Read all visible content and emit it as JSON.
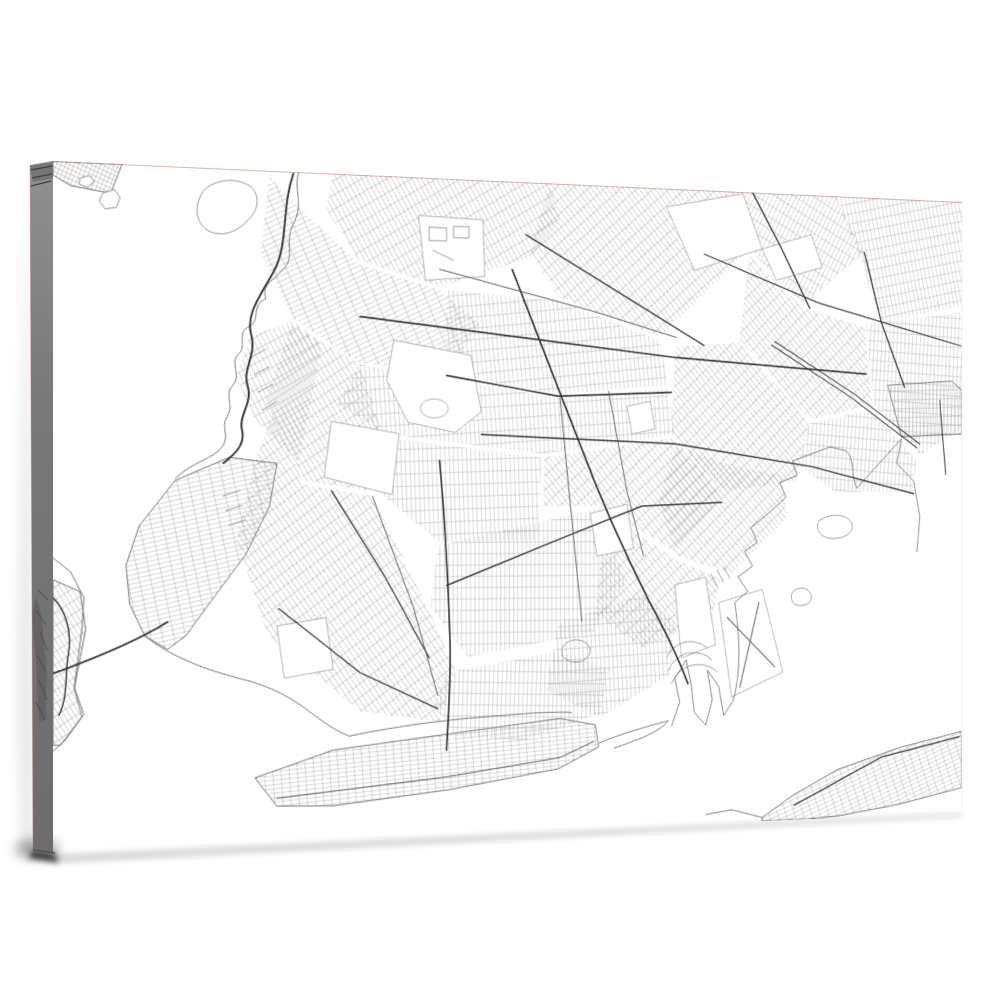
{
  "scene": {
    "description": "Gallery-wrapped canvas print mockup of a black-and-white Brooklyn street map, angled with left side edge visible",
    "background": "#ffffff",
    "canvas_face": "#ffffff",
    "canvas_side_top": "#909090",
    "canvas_side_mid": "#787878",
    "canvas_side_bottom": "#6d6d6d",
    "edge_hairline": "rgba(196,118,106,0.55)",
    "shadow_color": "#000000"
  },
  "map": {
    "colors": {
      "grid": "#8a8a8a",
      "coast": "#666666",
      "road": "#2f2f2f",
      "minor": "#555555",
      "park": "#8f8f8f",
      "detail": "#7f7f7f",
      "water": "#ffffff"
    },
    "districts": [
      {
        "n": "greenpoint-williamsburg",
        "a": -30,
        "w": 5,
        "h": 13,
        "p": "300,0 548,0 560,40 525,80 420,114 326,88 292,36"
      },
      {
        "n": "downtown-fortgreene",
        "a": -25,
        "w": 13,
        "h": 5,
        "p": "230,6 262,36 330,94 420,118 466,152 430,206 328,196 256,152 220,86"
      },
      {
        "n": "bushwick",
        "a": -40,
        "w": 5,
        "h": 12,
        "p": "548,0 762,0 790,62 680,162 560,122 524,76"
      },
      {
        "n": "ridgewood",
        "a": 28,
        "w": 5,
        "h": 12,
        "p": "762,0 898,0 936,62 858,122 800,72"
      },
      {
        "n": "queens-northeast",
        "a": -12,
        "w": 5,
        "h": 11,
        "p": "898,0 1063,0 1063,118 958,140 928,62"
      },
      {
        "n": "queens-east",
        "a": 3,
        "w": 5,
        "h": 11,
        "p": "938,142 1063,126 1063,258 1008,288 948,232"
      },
      {
        "n": "east-new-york",
        "a": -42,
        "w": 5,
        "h": 12,
        "p": "790,70 858,126 936,146 946,232 866,250 778,162"
      },
      {
        "n": "bedford-stuyvesant",
        "a": -6,
        "w": 5,
        "h": 12,
        "p": "428,118 560,126 680,166 690,214 558,226 428,206"
      },
      {
        "n": "crown-heights",
        "a": -4,
        "w": 5,
        "h": 13,
        "p": "330,198 558,230 690,218 698,268 538,290 358,270 304,240"
      },
      {
        "n": "brownsville",
        "a": -42,
        "w": 5,
        "h": 11,
        "p": "698,172 778,166 866,254 848,318 758,330 694,268"
      },
      {
        "n": "park-slope",
        "a": -32,
        "w": 5,
        "h": 12,
        "p": "254,158 330,198 356,272 340,330 268,320 226,238"
      },
      {
        "n": "flatbush",
        "a": -2,
        "w": 5,
        "h": 13,
        "p": "358,274 538,294 534,382 420,384 352,332"
      },
      {
        "n": "midwood",
        "a": 0,
        "w": 5,
        "h": 12,
        "p": "418,388 610,348 638,430 600,482 452,506 410,452"
      },
      {
        "n": "east-flatbush",
        "a": -40,
        "w": 5,
        "h": 12,
        "p": "542,294 694,272 758,334 698,396 610,346 540,346"
      },
      {
        "n": "canarsie",
        "a": -42,
        "w": 5,
        "h": 12,
        "p": "700,280 760,300 830,312 838,358 768,420 700,400 678,340"
      },
      {
        "n": "flatlands",
        "a": -40,
        "w": 5,
        "h": 12,
        "p": "614,352 698,404 754,426 744,468 658,500 602,462"
      },
      {
        "n": "borough-park-bensonhurst",
        "a": -35,
        "w": 5,
        "h": 12,
        "p": "234,250 268,324 344,336 408,456 438,520 420,574 330,560 228,480 194,380 214,300"
      },
      {
        "n": "sunset-park",
        "a": -28,
        "w": 5,
        "h": 12,
        "p": "208,172 256,154 288,178 262,300 214,258 194,214"
      },
      {
        "n": "bay-ridge",
        "a": -12,
        "w": 12,
        "h": 4.6,
        "o": 1,
        "p": "238,302 186,296 128,320 90,366 76,406 80,446 96,478 120,492 140,478 166,444 204,396 230,346"
      },
      {
        "n": "gravesend",
        "a": 2,
        "w": 5,
        "h": 12,
        "p": "428,522 558,502 618,522 608,570 518,596 438,590 414,556"
      },
      {
        "n": "sheepshead-bay",
        "a": -3,
        "w": 5,
        "h": 12,
        "p": "558,472 658,442 698,472 692,530 608,574 544,544"
      },
      {
        "n": "coney-island",
        "a": -4,
        "w": 9,
        "h": 4.5,
        "o": 1,
        "p": "214,626 300,600 440,586 560,574 602,582 606,606 558,628 430,646 300,658 238,656"
      },
      {
        "n": "rockaway",
        "a": -20,
        "w": 10,
        "h": 4.6,
        "o": 1,
        "p": "806,690 846,666 902,640 982,618 1063,602 1063,666 980,682 902,692 862,694 806,694"
      },
      {
        "n": "howard-beach",
        "a": -2,
        "w": 4.6,
        "h": 10,
        "o": 1,
        "p": "966,210 1050,204 1063,214 1063,264 984,268"
      },
      {
        "n": "staten-island-edge",
        "a": -32,
        "w": 4.6,
        "h": 11,
        "o": 1,
        "p": "0,420 28,432 34,470 22,530 30,558 8,586 0,586"
      },
      {
        "n": "manhattan-tip",
        "a": 22,
        "w": 4.2,
        "h": 4.5,
        "o": 1,
        "p": "0,0 72,0 60,30 18,24 0,14"
      },
      {
        "n": "ozone-park",
        "a": 4,
        "w": 5,
        "h": 12,
        "p": "866,254 946,238 1004,294 998,330 898,330 852,300"
      }
    ],
    "whites": [
      {
        "n": "prospect-park",
        "d": "M368,172 L456,186 L468,246 L438,268 L384,258 L360,214 Z"
      },
      {
        "n": "green-wood-cemetery",
        "d": "M298,258 L374,270 L366,334 L290,316 Z"
      },
      {
        "n": "evergreens-cemetery",
        "d": "M688,20 L782,2 L806,62 L722,88 Z"
      },
      {
        "n": "highland-park",
        "d": "M806,62 L868,44 L882,80 L824,96 Z"
      },
      {
        "n": "navy-yard",
        "d": "M396,40 L470,42 L472,102 L404,108 Z"
      },
      {
        "n": "dyker-park",
        "d": "M238,470 L292,462 L300,516 L246,524 Z"
      },
      {
        "n": "holy-cross-cemetery",
        "d": "M596,354 L640,344 L648,392 L604,400 Z"
      },
      {
        "n": "lincoln-terrace",
        "d": "M640,238 L668,232 L674,262 L646,268 Z"
      },
      {
        "n": "marine-park",
        "d": "M698,432 L736,424 L748,498 L706,512 Z"
      },
      {
        "n": "floyd-bennett-field",
        "d": "M752,452 L806,438 L832,530 L768,556 Z"
      },
      {
        "n": "prospect-lake",
        "d": "M398,242 a16,10 0 1 0 32,2 a16,10 0 1 0 -32,-2 Z"
      }
    ],
    "coasts": [
      {
        "n": "west-shore",
        "d": "M262,0 C256,18 268,34 256,54 C246,72 258,88 246,100 C236,112 220,118 226,132 C208,140 222,156 206,162 C194,170 206,182 196,190 C186,198 200,212 190,222 C180,232 192,242 184,254 C176,266 188,274 178,286 C168,298 148,300 128,318"
      },
      {
        "n": "gravesend-bay-shore",
        "d": "M96,478 C124,500 162,514 200,524 C232,532 256,546 272,558 C286,568 302,580 318,586"
      },
      {
        "n": "coney-creek",
        "d": "M318,586 C364,578 424,572 472,570 C512,568 546,566 574,568"
      },
      {
        "n": "sheepshead-inlet",
        "d": "M606,602 C634,592 662,586 690,580 M690,580 C680,592 652,600 624,608"
      },
      {
        "n": "gerritsen-coast",
        "d": "M694,586 L704,560 L698,534 L712,514 L718,542 L722,572 L736,586 L744,558 L738,526 L752,544 L758,576 L770,560"
      },
      {
        "n": "jamaica-bay-west",
        "d": "M770,560 C782,520 776,480 772,452 L788,440 L776,424 L794,412 L784,396 L800,386 L792,370 L814,354 L836,336 L828,320 L850,312 L844,296 L868,288 L892,280 L912,284 C924,292 918,310 926,326 L984,270"
      },
      {
        "n": "howard-coast",
        "d": "M984,270 L978,298 L1000,318 L1008,358 L1004,398"
      },
      {
        "n": "rockaway-inner",
        "d": "M806,690 L768,680 L736,684"
      },
      {
        "n": "staten-island-coast",
        "d": "M0,398 L18,412 L32,438 L30,470 L22,528 L32,556 L12,582 L0,592"
      }
    ],
    "islands": [
      {
        "n": "governors-island",
        "d": "M158,24 C170,10 198,8 210,18 C220,26 218,42 206,52 C194,66 174,72 160,62 C148,52 150,36 158,24 Z"
      },
      {
        "n": "liberty-island",
        "d": "M52,30 l12,-4 6,8 -4,10 -12,2 -6,-8 Z"
      },
      {
        "n": "ellis-island",
        "d": "M28,16 l10,-3 5,6 -8,6 -8,-3 Z"
      },
      {
        "n": "ruffle-bar",
        "d": "M878,362 c18,-10 38,-6 42,4 c4,10 -14,18 -28,16 c-14,-2 -20,-12 -14,-20 Z"
      },
      {
        "n": "canarsie-pol",
        "d": "M846,440 c10,-6 20,-2 22,6 c2,8 -10,12 -18,10 c-8,-2 -10,-12 -4,-16 Z"
      }
    ],
    "roads": [
      {
        "n": "bqe-gowanus-expwy",
        "w": 2,
        "d": "M256,2 C242,40 252,78 232,108 C218,132 204,150 210,170 C216,190 200,206 206,222 C212,240 196,252 200,268 C204,284 190,294 180,302"
      },
      {
        "n": "verrazzano-bridge",
        "w": 1.8,
        "d": "M120,464 C96,478 54,496 0,514"
      },
      {
        "n": "ocean-parkway",
        "w": 1.8,
        "d": "M420,298 C426,360 430,430 432,490 C433,530 430,568 428,604"
      },
      {
        "n": "flatbush-avenue",
        "w": 1.9,
        "d": "M504,94 C528,150 558,220 584,280 C608,338 638,398 666,448 C684,478 700,506 714,540"
      },
      {
        "n": "atlantic-avenue",
        "w": 1.7,
        "d": "M330,148 L700,184 L938,198"
      },
      {
        "n": "eastern-parkway",
        "w": 1.6,
        "d": "M428,208 L558,228 L694,222"
      },
      {
        "n": "linden-blvd",
        "w": 1.5,
        "d": "M468,270 L698,278 L868,302 L1000,332"
      },
      {
        "n": "kings-highway",
        "w": 1.4,
        "d": "M428,430 L558,382 L658,346 L756,342"
      },
      {
        "n": "conduit-ave-a",
        "w": 1.1,
        "d": "M818,168 L918,224 L1004,280"
      },
      {
        "n": "conduit-ave-b",
        "w": 1.1,
        "d": "M822,164 L922,220 L1008,276"
      },
      {
        "n": "jamaica-avenue",
        "w": 1.2,
        "d": "M734,70 L878,120 L1063,164"
      },
      {
        "n": "broadway",
        "w": 1.4,
        "d": "M520,56 L640,120 L734,170"
      },
      {
        "n": "myrtle-avenue",
        "w": 1,
        "c": "#555555",
        "d": "M420,96 L600,136 L700,162"
      },
      {
        "n": "new-utrecht-ave",
        "w": 1.3,
        "d": "M298,330 L358,420 L408,506"
      },
      {
        "n": "86th-street",
        "w": 1.2,
        "d": "M240,452 L330,520 L418,560"
      },
      {
        "n": "bay-parkway",
        "w": 1,
        "c": "#555555",
        "d": "M344,336 L390,452 L418,546"
      },
      {
        "n": "city-line",
        "w": 1.5,
        "d": "M794,0 L830,60 L866,126"
      },
      {
        "n": "woodhaven-blvd",
        "w": 1.5,
        "d": "M936,62 L958,140 L988,212"
      },
      {
        "n": "rockaway-spine",
        "w": 1.3,
        "d": "M846,678 L958,628 L1060,608"
      },
      {
        "n": "staten-island-road",
        "w": 1.4,
        "d": "M0,438 C12,450 20,470 16,494 C12,514 16,538 6,556"
      },
      {
        "n": "nostrand-ave",
        "w": 1,
        "c": "#555555",
        "d": "M560,230 L574,360 L586,470"
      },
      {
        "n": "utica-ave",
        "w": 1,
        "c": "#555555",
        "d": "M618,222 L640,330 L660,400"
      },
      {
        "n": "howard-vertical",
        "w": 1.2,
        "d": "M1034,226 L1042,310"
      },
      {
        "n": "coney-main",
        "w": 1,
        "c": "#555555",
        "d": "M238,648 L430,632 L560,616 L600,600"
      }
    ],
    "details": [
      {
        "n": "waterfront-piers",
        "d": "M226,184 l-16,9 M230,202 l-17,9 M234,220 l-17,9 M238,238 l-16,9 M198,330 l-19,6 M201,345 l-19,6 M204,360 l-19,6"
      },
      {
        "n": "gerritsen-arcs",
        "d": "M688,512 a30,26 0 0 1 50,-10 M690,526 a32,28 0 0 1 54,-11 M694,540 a34,30 0 0 1 56,-12"
      },
      {
        "n": "runways",
        "w": 1.5,
        "d": "M762,468 L822,524 M802,452 L778,546"
      },
      {
        "n": "oval-track",
        "d": "M562,502 a17,12 0 1 0 34,0 a17,12 0 1 0 -34,0"
      },
      {
        "n": "navy-docks",
        "d": "M408,52 l20,0 0,14 -20,0 Z M436,50 l18,0 0,12 -18,0 Z M412,76 l24,10"
      },
      {
        "n": "governors-lanes",
        "d": "M164,30 L204,46 M160,42 L196,58 M170,20 L208,32"
      },
      {
        "n": "mill-basin-fingers",
        "d": "M742,420 l8,14 M750,416 l8,14 M758,412 l8,14"
      }
    ]
  }
}
